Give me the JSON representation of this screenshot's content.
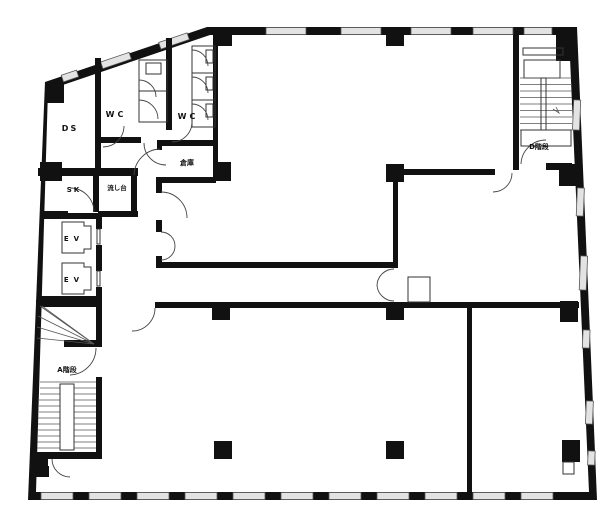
{
  "floorplan": {
    "rooms": {
      "ds": "DS",
      "wc_left": "WC",
      "wc_right": "WC",
      "storage": "倉庫",
      "sk": "SK",
      "sink": "流し台",
      "elevator_top": "EV",
      "elevator_bottom": "EV",
      "stair_a": "A階段",
      "stair_d": "D階段"
    },
    "colors": {
      "wall": "#111111",
      "window": "#e3e3e3",
      "background": "#ffffff"
    }
  }
}
